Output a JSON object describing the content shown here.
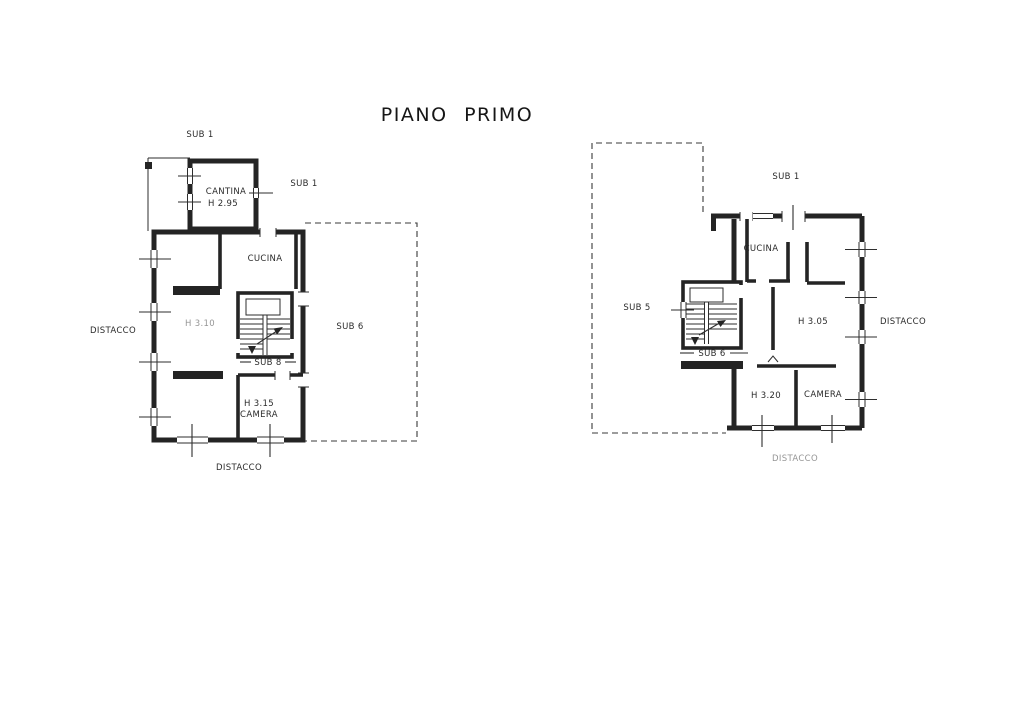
{
  "page": {
    "title": "PIANO PRIMO"
  },
  "colors": {
    "ink": "#242424",
    "paper": "#ffffff"
  },
  "left_plan": {
    "labels": {
      "sub1_top": "SUB 1",
      "sub1_right": "SUB 1",
      "cantina": "CANTINA",
      "cantina_height": "H 2.95",
      "cucina": "CUCINA",
      "main_height": "H 3.10",
      "sub6_area": "SUB 6",
      "sub8_stair": "SUB 8",
      "camera_height": "H 3.15",
      "camera": "CAMERA",
      "distacco_left": "DISTACCO",
      "distacco_bottom": "DISTACCO"
    }
  },
  "right_plan": {
    "labels": {
      "sub1_top": "SUB 1",
      "sub5_area": "SUB 5",
      "cucina": "CUCINA",
      "main_height": "H 3.05",
      "sub6_stair": "SUB 6",
      "h320": "H 3.20",
      "camera": "CAMERA",
      "distacco_right": "DISTACCO",
      "distacco_bottom": "DISTACCO"
    }
  }
}
